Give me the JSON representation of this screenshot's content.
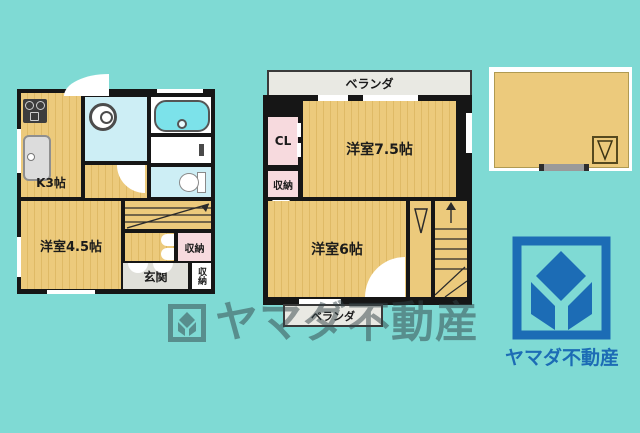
{
  "colors": {
    "bg": "#7fdad4",
    "wall": "#161616",
    "tatami": "#ecca7c",
    "tatami_stripe": "#dfba66",
    "closet_pink": "#f7dade",
    "water_cyan": "#cdeef5",
    "tub_cyan": "#7ce2ea",
    "veranda_gray": "#e9e9e3",
    "genkan_gray": "#e0e0da",
    "logo_blue": "#1c6cb5",
    "watermark": "rgba(50,66,70,0.5)"
  },
  "floor1": {
    "kitchen_label": "K3帖",
    "room_label": "洋室4.5帖",
    "entrance_label": "玄関",
    "storage_hall_label": "収納",
    "storage_entrance_label": "収納"
  },
  "floor2": {
    "veranda_top_label": "ベランダ",
    "veranda_bottom_label": "ベランダ",
    "closet_label": "CL",
    "storage_label": "収納",
    "room_large_label": "洋室7.5帖",
    "room_small_label": "洋室6帖"
  },
  "watermark": {
    "text": "ヤマダ不動産"
  },
  "logo": {
    "text": "ヤマダ不動産"
  },
  "icons": {
    "stove": "css-rect-with-burners",
    "sink": "css-rounded-rect",
    "washing_machine": "css-circle",
    "bathtub": "css-rounded-rect",
    "toilet": "css-ellipse-and-tank",
    "faucet": "css-rect",
    "stairs_up_arrow": "svg-arrow-line",
    "closet_hanger": "svg-triangle-outline",
    "door_swing": "css-quarter-circle",
    "logo_mark": "svg-diamond-y",
    "watermark_mark": "svg-diamond-y-in-square"
  }
}
